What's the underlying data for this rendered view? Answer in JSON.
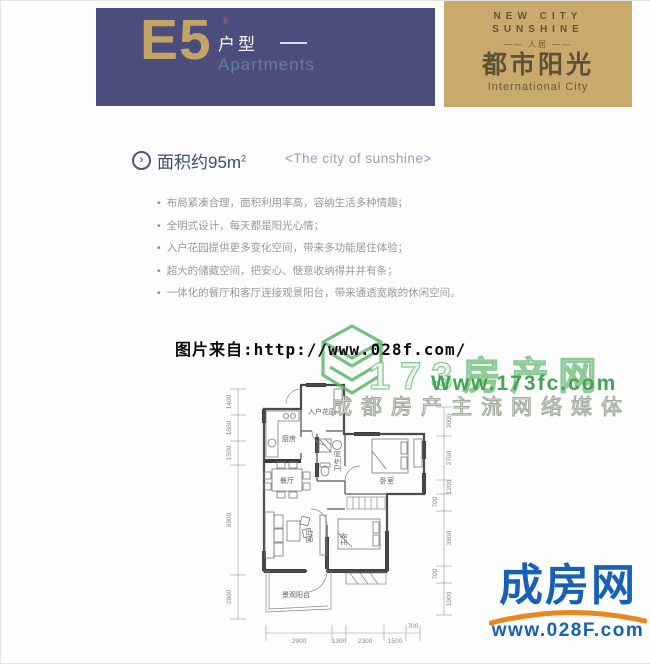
{
  "colors": {
    "banner_blue": "#4b4e7d",
    "banner_gold": "#c9a96c",
    "accent_gold_text": "#c3a462",
    "navy_text": "#3f4a76",
    "watermark_green": "#43a452",
    "logo_blue": "#1661b5",
    "logo_orange": "#e8881f"
  },
  "icons": {
    "area_marker": "›"
  },
  "header": {
    "type_code": "E5",
    "reg_mark": "®",
    "type_label": "户型",
    "type_label_en": "Apartments"
  },
  "brand": {
    "line1": "NEW CITY",
    "line2": "SUNSHINE",
    "line3": "—— 人居 ——",
    "name_cn": "都市阳光",
    "name_en": "International City"
  },
  "intro": {
    "area_label": "面积约95m",
    "area_sup": "2",
    "slogan": "<The city of sunshine>",
    "bullets": [
      "布局紧凑合理，面积利用率高，容纳生活多种情趣；",
      "全明式设计，每天都是阳光心情；",
      "入户花园提供更多变化空间，带来多功能居住体验；",
      "超大的储藏空间，把安心、惬意收纳得井井有条；",
      "一体化的餐厅和客厅连接观景阳台，带来通透宽敞的休闲空间。"
    ]
  },
  "watermarks": {
    "photo_source": "图片来自:http://www.028f.com/",
    "site1_name": "173房产网",
    "site1_url": "Www.173fc.com",
    "site1_tagline": "成都房产主流网络媒体",
    "site2_name": "成房网",
    "site2_url": "www.028F.com"
  },
  "floorplan": {
    "rooms": {
      "entry_garden": "入户花园",
      "kitchen": "厨房",
      "bathroom": "卫生间",
      "bedroom": "卧室",
      "dining": "餐厅",
      "living": "客厅",
      "master_bedroom": "主卧",
      "balcony": "景观阳台"
    },
    "dims_left": [
      "1400",
      "1600",
      "1500",
      "6900",
      "2800"
    ],
    "dims_right": [
      "3000",
      "2700",
      "1200",
      "700",
      "3800",
      "700",
      "1900"
    ],
    "dims_bottom": [
      "2900",
      "1300",
      "2300",
      "1500",
      "700"
    ]
  }
}
